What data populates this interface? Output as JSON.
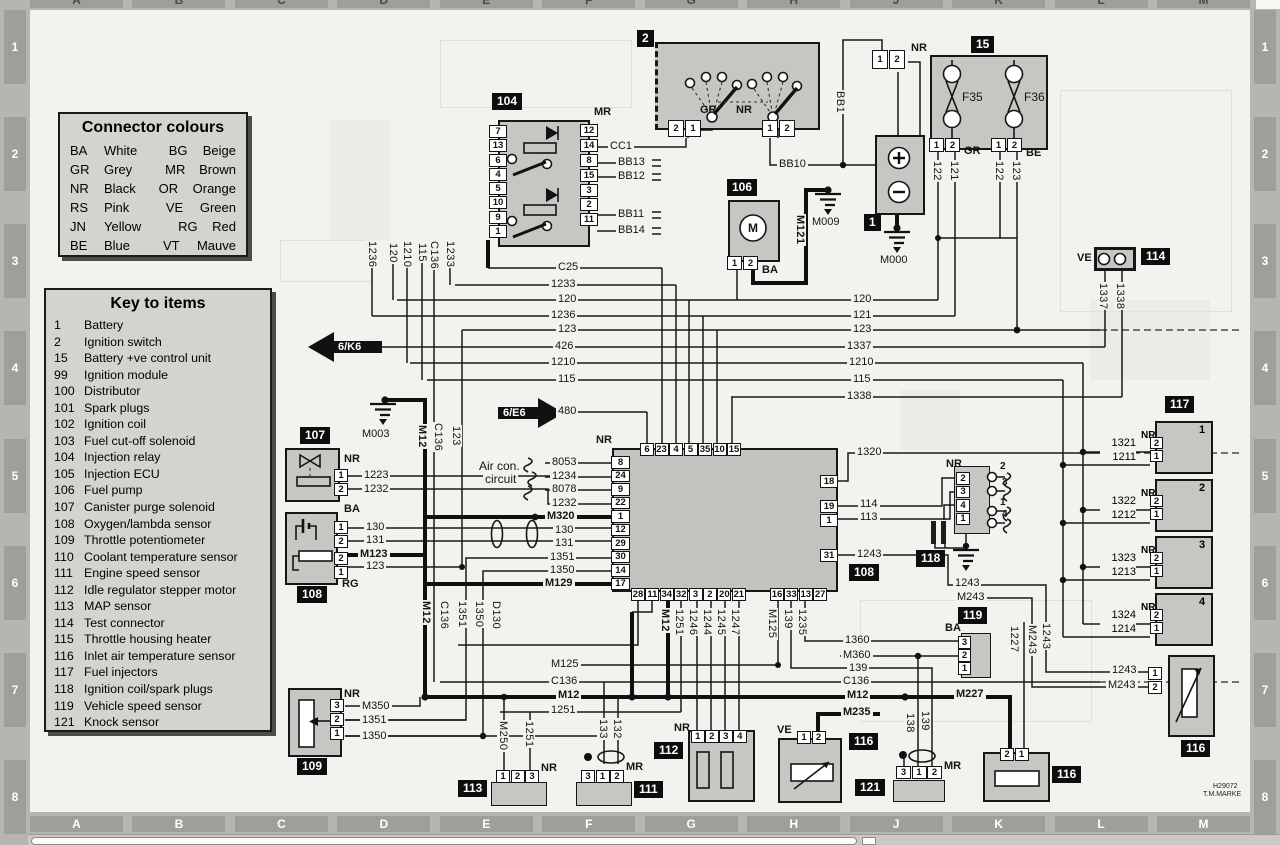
{
  "legend": {
    "title": "Connector colours",
    "entries": [
      [
        "BA",
        "White",
        "BG",
        "Beige"
      ],
      [
        "GR",
        "Grey",
        "MR",
        "Brown"
      ],
      [
        "NR",
        "Black",
        "OR",
        "Orange"
      ],
      [
        "RS",
        "Pink",
        "VE",
        "Green"
      ],
      [
        "JN",
        "Yellow",
        "RG",
        "Red"
      ],
      [
        "BE",
        "Blue",
        "VT",
        "Mauve"
      ]
    ]
  },
  "key": {
    "title": "Key to items",
    "items": [
      [
        "1",
        "Battery"
      ],
      [
        "2",
        "Ignition switch"
      ],
      [
        "15",
        "Battery +ve control unit"
      ],
      [
        "99",
        "Ignition module"
      ],
      [
        "100",
        "Distributor"
      ],
      [
        "101",
        "Spark plugs"
      ],
      [
        "102",
        "Ignition coil"
      ],
      [
        "103",
        "Fuel cut-off solenoid"
      ],
      [
        "104",
        "Injection relay"
      ],
      [
        "105",
        "Injection ECU"
      ],
      [
        "106",
        "Fuel pump"
      ],
      [
        "107",
        "Canister purge solenoid"
      ],
      [
        "108",
        "Oxygen/lambda sensor"
      ],
      [
        "109",
        "Throttle potentiometer"
      ],
      [
        "110",
        "Coolant temperature sensor"
      ],
      [
        "111",
        "Engine speed sensor"
      ],
      [
        "112",
        "Idle regulator stepper motor"
      ],
      [
        "113",
        "MAP sensor"
      ],
      [
        "114",
        "Test connector"
      ],
      [
        "115",
        "Throttle housing heater"
      ],
      [
        "116",
        "Inlet air temperature sensor"
      ],
      [
        "117",
        "Fuel injectors"
      ],
      [
        "118",
        "Ignition coil/spark plugs"
      ],
      [
        "119",
        "Vehicle speed sensor"
      ],
      [
        "121",
        "Knock sensor"
      ]
    ]
  },
  "grid": {
    "cols": [
      "A",
      "B",
      "C",
      "D",
      "E",
      "F",
      "G",
      "H",
      "J",
      "K",
      "L",
      "M"
    ],
    "rows": [
      "1",
      "2",
      "3",
      "4",
      "5",
      "6",
      "7",
      "8"
    ]
  },
  "relay104": {
    "tag": "104",
    "color": "MR",
    "left_pins": [
      "7",
      "13",
      "6",
      "4",
      "5",
      "10",
      "9",
      "1"
    ],
    "right_pins": [
      "12",
      "14",
      "8",
      "15",
      "3",
      "2",
      "11"
    ],
    "w_cc1": "CC1",
    "w_bb13": "BB13",
    "w_bb12": "BB12",
    "w_bb11": "BB11",
    "w_bb14": "BB14",
    "drops": [
      "1236",
      "120",
      "1210",
      "115",
      "C136",
      "1233"
    ]
  },
  "ignition2": {
    "tag": "2",
    "gr": "GR",
    "nr": "NR",
    "conn_left": [
      "2",
      "1"
    ],
    "conn_right": [
      "1",
      "2"
    ],
    "bb1": "BB1",
    "bb10": "BB10"
  },
  "battery1": {
    "tag": "1",
    "conn_color": "NR",
    "conn": [
      "1",
      "2"
    ],
    "m000": "M000",
    "m009": "M009"
  },
  "unit15": {
    "tag": "15",
    "f1": "F35",
    "f2": "F36",
    "conn1": [
      "1",
      "2"
    ],
    "c1": "GR",
    "conn2": [
      "1",
      "2"
    ],
    "c2": "BE",
    "d1": "122",
    "d2": "121",
    "d3": "122",
    "d4": "123"
  },
  "pump106": {
    "tag": "106",
    "m": "M",
    "conn": [
      "1",
      "2"
    ],
    "color": "BA",
    "m121": "M121"
  },
  "test114": {
    "tag": "114",
    "color": "VE",
    "d1": "1337",
    "d2": "1338"
  },
  "buses": {
    "left": [
      "C25",
      "1233",
      "120",
      "1236",
      "123",
      "426",
      "1210",
      "115"
    ],
    "right": [
      "120",
      "121",
      "123",
      "1337",
      "1210",
      "115",
      "1338"
    ],
    "k6": "6/K6",
    "e6": "6/E6",
    "w480": "480",
    "m003": "M003"
  },
  "mid_verts": {
    "m12": "M12",
    "c136": "C136",
    "n123": "123"
  },
  "purge107": {
    "tag": "107",
    "color": "NR",
    "pins": [
      "1",
      "2"
    ],
    "w1": "1223",
    "w2": "1232"
  },
  "lambda108": {
    "tag": "108",
    "ba": "BA",
    "rg": "RG",
    "pins_a": [
      "1",
      "2"
    ],
    "pins_b": [
      "2",
      "1"
    ],
    "w1": "130",
    "w2": "131",
    "w3": "M123",
    "w4": "123"
  },
  "throttle109": {
    "tag": "109",
    "color": "NR",
    "pins": [
      "3",
      "2",
      "1"
    ],
    "w1": "M350",
    "w2": "1351",
    "w3": "1350"
  },
  "ecu": {
    "tag": "108",
    "color": "NR",
    "aircon1": "Air con.",
    "aircon2": "circuit",
    "top_pins": [
      "6",
      "23",
      "4",
      "5",
      "35",
      "10",
      "15"
    ],
    "left_pins": [
      "8",
      "24",
      "9",
      "22",
      "1",
      "12",
      "29",
      "30",
      "14",
      "17"
    ],
    "lw": [
      "8053",
      "1234",
      "8078",
      "1232",
      "M320",
      "130",
      "131",
      "1351",
      "1350",
      "M129"
    ],
    "right_pins": [
      "18",
      "19",
      "1",
      "31"
    ],
    "rw1": "1320",
    "rw2": "114",
    "rw3": "113",
    "rw4": "1243",
    "bottom_pins_a": [
      "28",
      "11",
      "34",
      "32",
      "3",
      "2",
      "20",
      "21"
    ],
    "bottom_pins_b": [
      "16",
      "33",
      "13",
      "27"
    ],
    "da": [
      "M12",
      "1251",
      "1246",
      "1244",
      "1245",
      "1247"
    ],
    "db": [
      "M125",
      "139",
      "1235"
    ]
  },
  "low_verts": [
    "M12",
    "C136",
    "1351",
    "1350",
    "D130"
  ],
  "coil118": {
    "tag": "118",
    "color": "NR",
    "pins": [
      "2",
      "3",
      "4",
      "1"
    ],
    "plugs": [
      "2",
      "3",
      "1",
      "4"
    ]
  },
  "speed119": {
    "tag": "119",
    "color": "BA",
    "pins": [
      "3",
      "2",
      "1"
    ],
    "w1": "1243",
    "w2": "M243"
  },
  "bottom_buses": {
    "l1": "M125",
    "l2": "C136",
    "l3": "M12",
    "l4": "1251",
    "r1": "1360",
    "r2": "M360",
    "r3": "139",
    "r4": "C136",
    "r5": "M12",
    "r6": "M235",
    "m227": "M227",
    "v1": "1227",
    "v2": "M243",
    "v3": "1243"
  },
  "map113": {
    "tag": "113",
    "color": "NR",
    "pins": [
      "1",
      "2",
      "3"
    ],
    "d1": "M250",
    "d2": "1251"
  },
  "rpm111": {
    "tag": "111",
    "color": "MR",
    "pins": [
      "3",
      "1",
      "2"
    ],
    "d1": "133",
    "d2": "132"
  },
  "stepper112": {
    "tag": "112",
    "color": "NR",
    "pins": [
      "1",
      "2",
      "3",
      "4"
    ]
  },
  "temp116h": {
    "tag": "116",
    "color": "VE",
    "pins": [
      "1",
      "2"
    ]
  },
  "knock121": {
    "tag": "121",
    "color": "MR",
    "pins": [
      "3",
      "1",
      "2"
    ],
    "d1": "138",
    "d2": "139"
  },
  "temp116k": {
    "tag": "116",
    "pins": [
      "2",
      "1"
    ]
  },
  "temp116r": {
    "tag": "116",
    "pins": [
      "1",
      "2"
    ],
    "w1": "1243",
    "w2": "M243"
  },
  "injectors": {
    "tag": "117",
    "units": [
      {
        "num": "1",
        "color": "NR",
        "p1": "2",
        "p2": "1",
        "w1": "1321",
        "w2": "1211"
      },
      {
        "num": "2",
        "color": "NR",
        "p1": "2",
        "p2": "1",
        "w1": "1322",
        "w2": "1212"
      },
      {
        "num": "3",
        "color": "NR",
        "p1": "2",
        "p2": "1",
        "w1": "1323",
        "w2": "1213"
      },
      {
        "num": "4",
        "color": "NR",
        "p1": "2",
        "p2": "1",
        "w1": "1324",
        "w2": "1214"
      }
    ]
  },
  "footer": {
    "ref": "H29072",
    "credit": "T.M.MARKE"
  }
}
